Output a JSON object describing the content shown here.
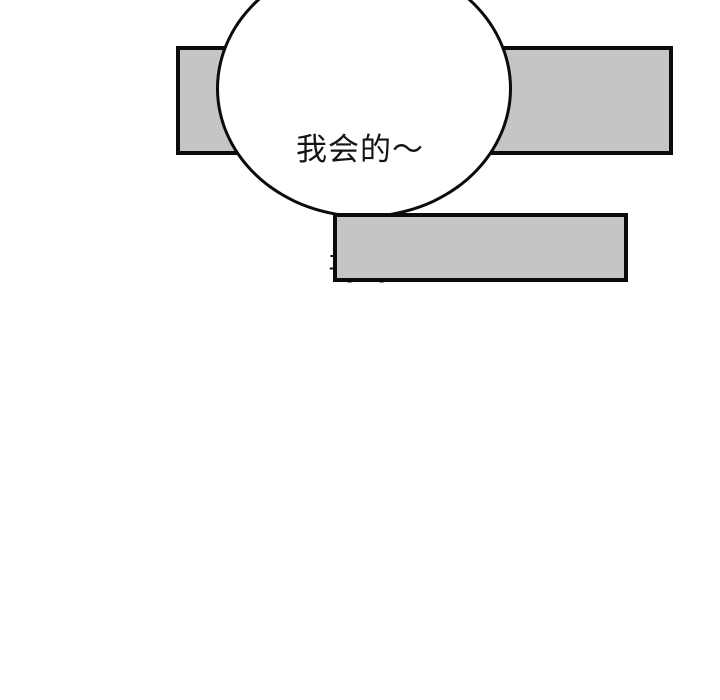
{
  "page": {
    "type": "comic-panel",
    "background_color": "#ffffff"
  },
  "speech_bubble": {
    "shape": "ellipse",
    "fill_color": "#ffffff",
    "stroke_color": "#0b0b0b",
    "text_color": "#151515",
    "lines": {
      "line1": "我会的～",
      "line2": "哥哥"
    }
  },
  "censored_panels": {
    "fill_color": "#c5c5c5",
    "stroke_color": "#0b0b0b",
    "count": 2
  }
}
